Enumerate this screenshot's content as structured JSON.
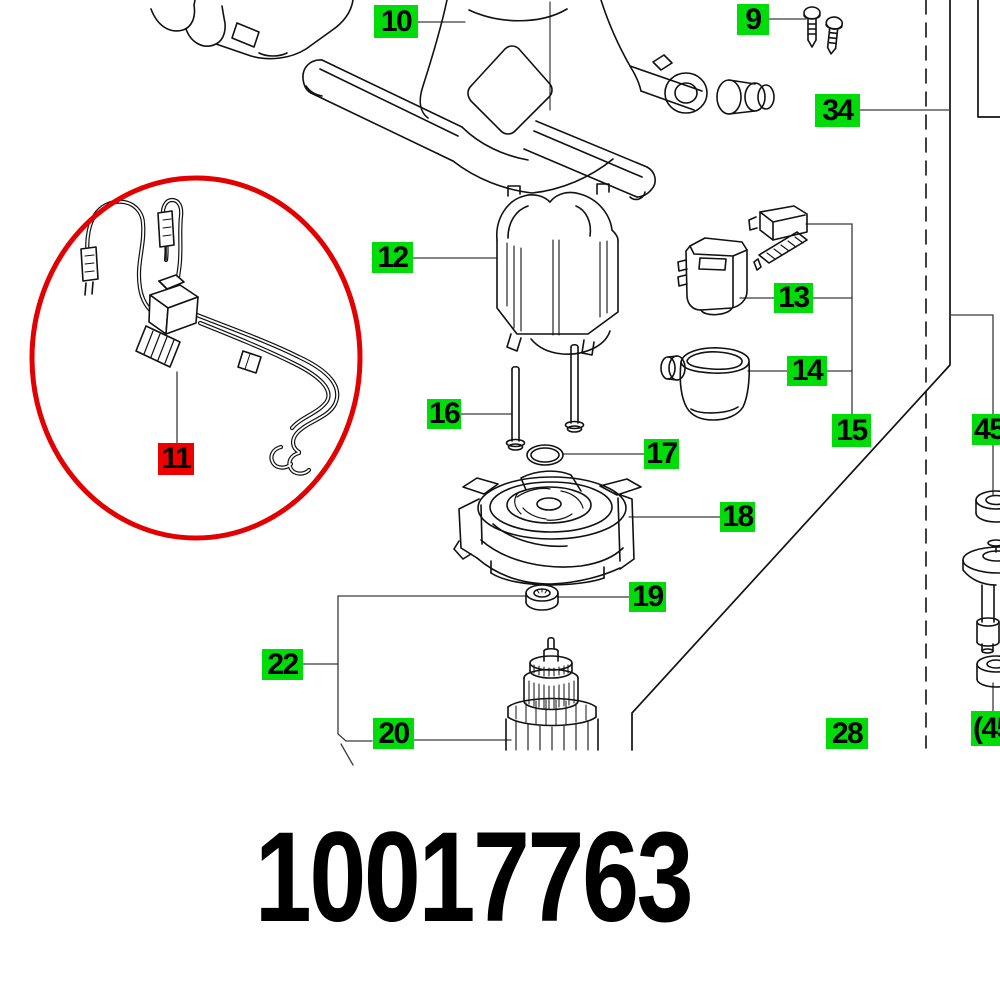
{
  "diagram": {
    "type": "exploded-parts-diagram",
    "part_number": "10017763",
    "highlighted_item": "11",
    "badges": [
      {
        "label": "9",
        "type": "green"
      },
      {
        "label": "10",
        "type": "green"
      },
      {
        "label": "34",
        "type": "green"
      },
      {
        "label": "11",
        "type": "red"
      },
      {
        "label": "12",
        "type": "green"
      },
      {
        "label": "13",
        "type": "green"
      },
      {
        "label": "14",
        "type": "green"
      },
      {
        "label": "15",
        "type": "green"
      },
      {
        "label": "16",
        "type": "green"
      },
      {
        "label": "17",
        "type": "green"
      },
      {
        "label": "18",
        "type": "green"
      },
      {
        "label": "19",
        "type": "green"
      },
      {
        "label": "20",
        "type": "green"
      },
      {
        "label": "22",
        "type": "green"
      },
      {
        "label": "28",
        "type": "green"
      },
      {
        "label": "45",
        "type": "green"
      },
      {
        "label": "(45",
        "type": "green"
      }
    ],
    "colors": {
      "badge_green": "#00DC0A",
      "badge_red": "#EE0000",
      "highlight_circle": "#E30000",
      "line_art": "#111111",
      "leader_line": "#3a3a3a",
      "background": "#FFFFFF"
    }
  }
}
